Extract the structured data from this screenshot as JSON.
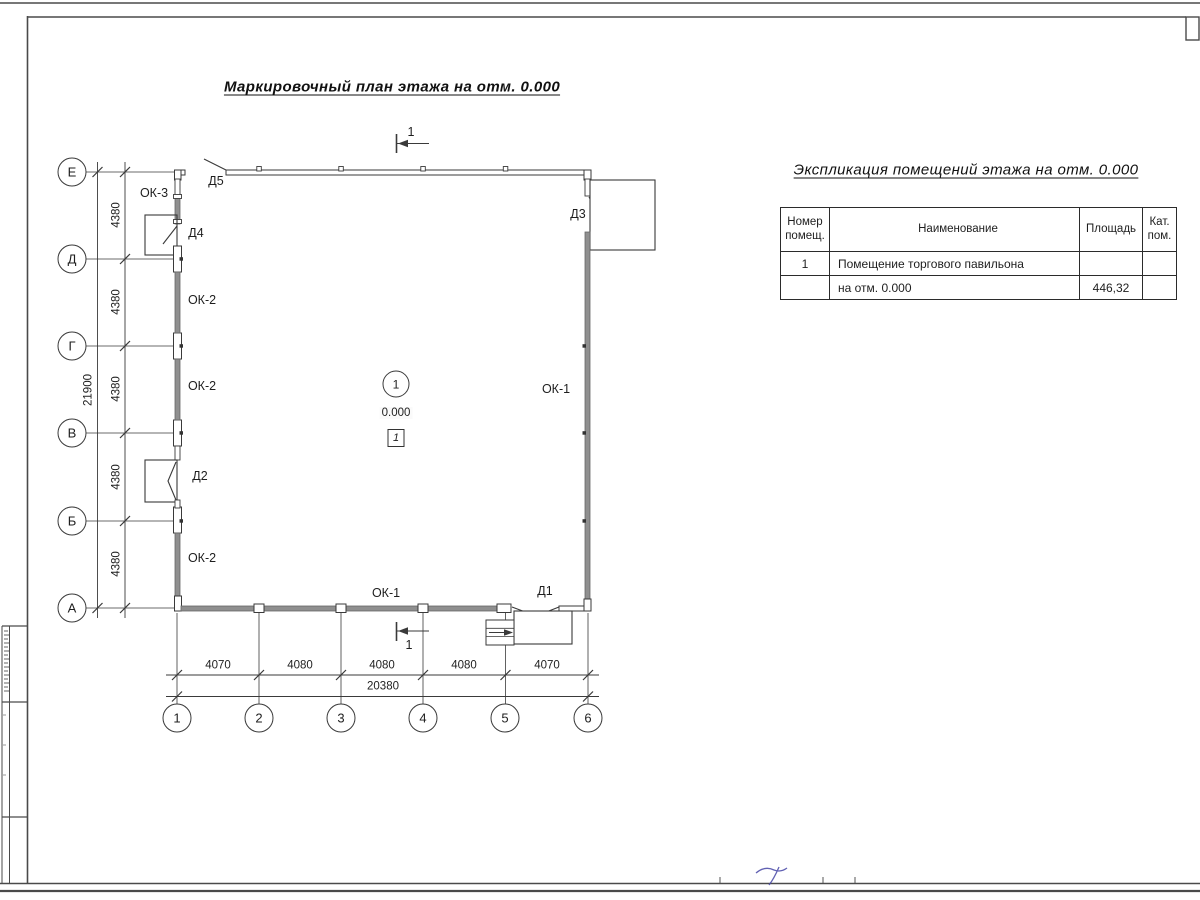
{
  "colors": {
    "line": "#3a3a3a",
    "glazing_fill": "#8f8f8f",
    "pen_note_blue": "#4646a6",
    "paper": "#ffffff"
  },
  "plan": {
    "title": "Маркировочный план этажа на отм. 0.000",
    "row_axes": [
      "Е",
      "Д",
      "Г",
      "В",
      "Б",
      "А"
    ],
    "col_axes": [
      "1",
      "2",
      "3",
      "4",
      "5",
      "6"
    ],
    "row_dims": [
      "4380",
      "4380",
      "4380",
      "4380",
      "4380"
    ],
    "row_total": "21900",
    "col_dims": [
      "4070",
      "4080",
      "4080",
      "4080",
      "4070"
    ],
    "col_total": "20380",
    "marks": {
      "ok1": "ОК-1",
      "ok2": "ОК-2",
      "ok3": "ОК-3",
      "d1": "Д1",
      "d2": "Д2",
      "d3": "Д3",
      "d4": "Д4",
      "d5": "Д5"
    },
    "room": {
      "number": "1",
      "elevation": "0.000",
      "zone": "1"
    },
    "section": {
      "label": "1"
    }
  },
  "table": {
    "title": "Экспликация помещений этажа на отм. 0.000",
    "headers": {
      "num": "Номер помещ.",
      "name": "Наименование",
      "area": "Площадь",
      "cat": "Кат. пом."
    },
    "rows": [
      {
        "num": "1",
        "name": "Помещение торгового павильона",
        "area": "",
        "cat": ""
      },
      {
        "num": "",
        "name": "на отм. 0.000",
        "area": "446,32",
        "cat": ""
      }
    ]
  }
}
